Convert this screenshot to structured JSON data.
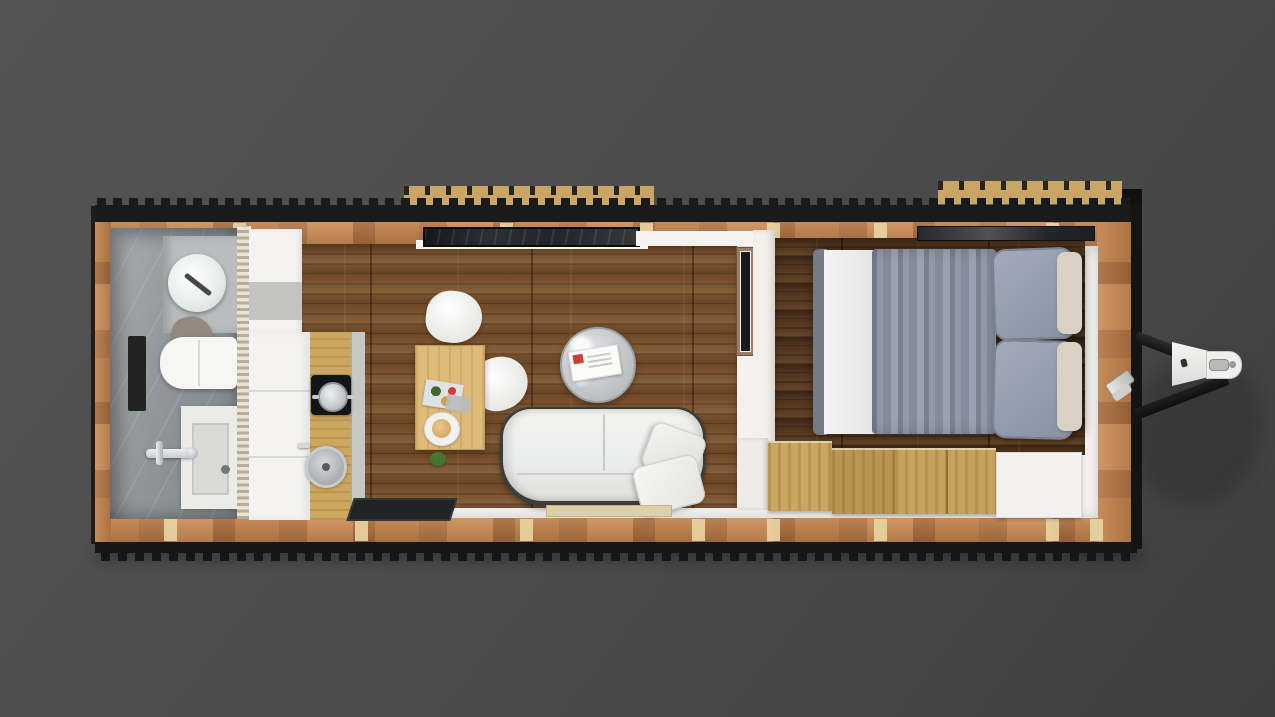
{
  "scene": {
    "kind": "tiny-house-trailer-floor-plan-top-view",
    "rooms": [
      {
        "id": "bathroom",
        "items": [
          "vessel-sink",
          "sink-faucet",
          "towel",
          "toilet",
          "wall-niche",
          "shower-tray",
          "shower-drain",
          "shower-mixer"
        ]
      },
      {
        "id": "kitchen",
        "items": [
          "upper-counter",
          "tall-cabinet",
          "wood-counter",
          "cooktop",
          "pot",
          "round-sink",
          "faucet",
          "floor-mat"
        ]
      },
      {
        "id": "living-room",
        "items": [
          "top-window",
          "dining-table",
          "chair",
          "chair",
          "magazine",
          "plate",
          "tray",
          "plant",
          "coffee-table",
          "magazine",
          "sofa",
          "cushion",
          "cushion",
          "doormat",
          "tv-panel"
        ]
      },
      {
        "id": "bedroom",
        "items": [
          "top-window",
          "double-bed",
          "folded-sheet",
          "duvet",
          "pillow",
          "pillow",
          "headboard-cushion",
          "headboard-cushion",
          "storage-step",
          "storage-step",
          "storage-step",
          "storage-box"
        ]
      }
    ],
    "exterior": [
      "trailer-rail-top",
      "trailer-rail-bottom",
      "wood-rim",
      "wall-studs",
      "roof-slats-left",
      "roof-slats-right",
      "trailer-hitch-drawbar",
      "hitch-coupler",
      "stabilizer-jack"
    ]
  },
  "palette": {
    "bg_top": "#545454",
    "bg_mid": "#4c4c4c",
    "bg_bottom": "#3e3e3e",
    "rail": "#1a1a1a",
    "rim_wood": "#c08049",
    "rim_wood_light": "#cb8b55",
    "rim_wood_dark": "#a76a3a",
    "stud": "#e8d2a4",
    "interior": "#f2f1ee",
    "bath_tile": "#8f979b",
    "bath_tile_light": "#a7afb2",
    "counter_gray": "#b9bdbf",
    "living_floor": "#6f4827",
    "living_floor_light": "#86603a",
    "living_floor_dark": "#4e2f15",
    "bedroom_floor": "#4e331c",
    "bedroom_floor_light": "#64452a",
    "bedroom_floor_dark": "#33200f",
    "step_wood": "#c7a25c",
    "table_wood": "#debb79",
    "counter_wood": "#cda75e",
    "cabinet_white": "#f4f3f1",
    "sofa_edge": "#3c3c3a",
    "sofa_fabric": "#eceded",
    "duvet": "#848c9b",
    "pillow": "#8791a1",
    "sheet": "#f4f4f4",
    "headboard": "#d9d1c4",
    "glass": "#22262b",
    "mat_dark": "#212325",
    "doormat": "#dcd2a6",
    "metal": "#c9ccce",
    "accent_red": "#d23b30",
    "plant_green": "#3f6b2a",
    "tv_wood": "#9c7c64",
    "awning": "#c9a566"
  }
}
